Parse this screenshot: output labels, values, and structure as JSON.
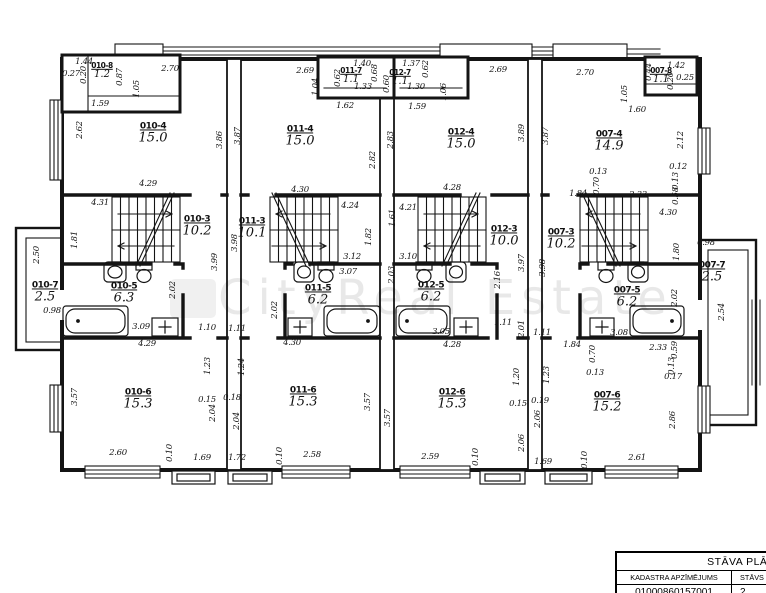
{
  "watermark": {
    "text": "CityReal Estate"
  },
  "title_block": {
    "title": "STĀVA PLĀNS",
    "col1_header": "KADASTRA APZĪMĒJUMS",
    "col2_header": "STĀVS",
    "col1_value": "01000860157001",
    "col2_value": "2"
  },
  "rooms": [
    {
      "id": "010-8",
      "area": "1.2",
      "x": 102,
      "y": 71,
      "s": 1
    },
    {
      "id": "011-7",
      "area": "1.1",
      "x": 351,
      "y": 76,
      "s": 1
    },
    {
      "id": "012-7",
      "area": "1.1",
      "x": 400,
      "y": 78,
      "s": 1
    },
    {
      "id": "007-8",
      "area": "1.1",
      "x": 661,
      "y": 76,
      "s": 1
    },
    {
      "id": "010-4",
      "area": "15.0",
      "x": 153,
      "y": 134
    },
    {
      "id": "011-4",
      "area": "15.0",
      "x": 300,
      "y": 137
    },
    {
      "id": "012-4",
      "area": "15.0",
      "x": 461,
      "y": 140
    },
    {
      "id": "007-4",
      "area": "14.9",
      "x": 609,
      "y": 142
    },
    {
      "id": "010-3",
      "area": "10.2",
      "x": 197,
      "y": 227
    },
    {
      "id": "011-3",
      "area": "10.1",
      "x": 252,
      "y": 229
    },
    {
      "id": "012-3",
      "area": "10.0",
      "x": 504,
      "y": 237
    },
    {
      "id": "007-3",
      "area": "10.2",
      "x": 561,
      "y": 240
    },
    {
      "id": "010-7",
      "area": "2.5",
      "x": 45,
      "y": 293
    },
    {
      "id": "007-7",
      "area": "2.5",
      "x": 712,
      "y": 273
    },
    {
      "id": "010-5",
      "area": "6.3",
      "x": 124,
      "y": 294
    },
    {
      "id": "011-5",
      "area": "6.2",
      "x": 318,
      "y": 296
    },
    {
      "id": "012-5",
      "area": "6.2",
      "x": 431,
      "y": 293
    },
    {
      "id": "007-5",
      "area": "6.2",
      "x": 627,
      "y": 298
    },
    {
      "id": "010-6",
      "area": "15.3",
      "x": 138,
      "y": 400
    },
    {
      "id": "011-6",
      "area": "15.3",
      "x": 303,
      "y": 398
    },
    {
      "id": "012-6",
      "area": "15.3",
      "x": 452,
      "y": 400
    },
    {
      "id": "007-6",
      "area": "15.2",
      "x": 607,
      "y": 403
    }
  ],
  "dims": [
    [
      "1.44",
      84,
      62,
      0
    ],
    [
      "0.27",
      71,
      74,
      0
    ],
    [
      "0.20",
      84,
      75,
      1
    ],
    [
      "0.87",
      120,
      77,
      1
    ],
    [
      "2.70",
      170,
      69,
      0
    ],
    [
      "1.05",
      137,
      89,
      1
    ],
    [
      "1.59",
      100,
      104,
      0
    ],
    [
      "2.62",
      80,
      130,
      1
    ],
    [
      "3.86",
      220,
      140,
      1
    ],
    [
      "4.29",
      148,
      184,
      0
    ],
    [
      "4.31",
      100,
      203,
      0
    ],
    [
      "1.81",
      75,
      240,
      1
    ],
    [
      "3.99",
      215,
      262,
      1
    ],
    [
      "2.02",
      173,
      290,
      1
    ],
    [
      "3.09",
      141,
      327,
      0
    ],
    [
      "1.10",
      207,
      328,
      0
    ],
    [
      "4.29",
      147,
      344,
      0
    ],
    [
      "2.50",
      37,
      255,
      1
    ],
    [
      "0.98",
      52,
      311,
      0
    ],
    [
      "1.23",
      208,
      366,
      1
    ],
    [
      "3.57",
      75,
      397,
      1
    ],
    [
      "0.15",
      207,
      400,
      0
    ],
    [
      "2.04",
      213,
      413,
      1
    ],
    [
      "2.60",
      118,
      453,
      0
    ],
    [
      "0.10",
      170,
      453,
      1
    ],
    [
      "1.69",
      202,
      458,
      0
    ],
    [
      "2.69",
      305,
      71,
      0
    ],
    [
      "1.40",
      362,
      64,
      0
    ],
    [
      "0.68",
      375,
      73,
      1
    ],
    [
      "0.62",
      338,
      78,
      1
    ],
    [
      "1.33",
      363,
      87,
      0
    ],
    [
      "1.04",
      316,
      87,
      1
    ],
    [
      "1.62",
      345,
      106,
      0
    ],
    [
      "1.37",
      411,
      64,
      0
    ],
    [
      "0.62",
      426,
      69,
      1
    ],
    [
      "0.60",
      387,
      84,
      1
    ],
    [
      "1.30",
      416,
      87,
      0
    ],
    [
      "1.06",
      444,
      92,
      1
    ],
    [
      "1.59",
      417,
      107,
      0
    ],
    [
      "2.69",
      498,
      70,
      0
    ],
    [
      "3.87",
      238,
      136,
      1
    ],
    [
      "2.82",
      373,
      160,
      1
    ],
    [
      "2.83",
      391,
      140,
      1
    ],
    [
      "3.89",
      522,
      133,
      1
    ],
    [
      "4.30",
      300,
      190,
      0
    ],
    [
      "4.28",
      452,
      188,
      0
    ],
    [
      "4.24",
      350,
      206,
      0
    ],
    [
      "1.82",
      369,
      237,
      1
    ],
    [
      "3.12",
      352,
      257,
      0
    ],
    [
      "3.98",
      235,
      243,
      1
    ],
    [
      "2.02",
      275,
      310,
      1
    ],
    [
      "3.07",
      348,
      272,
      0
    ],
    [
      "1.11",
      237,
      329,
      0
    ],
    [
      "4.30",
      292,
      343,
      0
    ],
    [
      "1.24",
      242,
      367,
      1
    ],
    [
      "0.18",
      232,
      398,
      0
    ],
    [
      "2.04",
      237,
      421,
      1
    ],
    [
      "1.72",
      237,
      458,
      0
    ],
    [
      "0.10",
      280,
      456,
      1
    ],
    [
      "2.58",
      312,
      455,
      0
    ],
    [
      "3.57",
      368,
      402,
      1
    ],
    [
      "4.21",
      408,
      208,
      0
    ],
    [
      "1.61",
      393,
      218,
      1
    ],
    [
      "3.10",
      408,
      257,
      0
    ],
    [
      "3.97",
      522,
      263,
      1
    ],
    [
      "2.16",
      498,
      280,
      1
    ],
    [
      "2.03",
      392,
      275,
      1
    ],
    [
      "3.05",
      441,
      332,
      0
    ],
    [
      "1.11",
      503,
      323,
      0
    ],
    [
      "2.01",
      522,
      329,
      1
    ],
    [
      "4.28",
      452,
      345,
      0
    ],
    [
      "3.57",
      388,
      418,
      1
    ],
    [
      "2.59",
      430,
      457,
      0
    ],
    [
      "0.10",
      476,
      457,
      1
    ],
    [
      "1.20",
      517,
      377,
      1
    ],
    [
      "0.15",
      518,
      404,
      0
    ],
    [
      "2.06",
      522,
      443,
      1
    ],
    [
      "2.70",
      585,
      73,
      0
    ],
    [
      "0.44",
      649,
      72,
      1
    ],
    [
      "1.42",
      676,
      66,
      0
    ],
    [
      "0.20",
      671,
      81,
      1
    ],
    [
      "0.25",
      685,
      78,
      0
    ],
    [
      "1.05",
      625,
      94,
      1
    ],
    [
      "1.60",
      637,
      110,
      0
    ],
    [
      "3.87",
      546,
      136,
      1
    ],
    [
      "2.12",
      681,
      140,
      1
    ],
    [
      "0.12",
      678,
      167,
      0
    ],
    [
      "0.13",
      676,
      181,
      1
    ],
    [
      "0.58",
      676,
      196,
      1
    ],
    [
      "0.13",
      598,
      172,
      0
    ],
    [
      "0.70",
      597,
      186,
      1
    ],
    [
      "1.84",
      578,
      194,
      0
    ],
    [
      "2.33",
      638,
      195,
      0
    ],
    [
      "4.30",
      668,
      213,
      0
    ],
    [
      "1.80",
      677,
      252,
      1
    ],
    [
      "3.98",
      543,
      268,
      1
    ],
    [
      "0.98",
      706,
      243,
      0
    ],
    [
      "2.02",
      675,
      298,
      1
    ],
    [
      "2.54",
      722,
      312,
      1
    ],
    [
      "3.08",
      619,
      333,
      0
    ],
    [
      "1.11",
      542,
      333,
      0
    ],
    [
      "1.84",
      572,
      345,
      0
    ],
    [
      "2.33",
      658,
      348,
      0
    ],
    [
      "1.23",
      547,
      375,
      1
    ],
    [
      "0.19",
      540,
      401,
      0
    ],
    [
      "2.06",
      538,
      419,
      1
    ],
    [
      "1.69",
      543,
      462,
      0
    ],
    [
      "0.70",
      593,
      354,
      1
    ],
    [
      "0.13",
      595,
      373,
      0
    ],
    [
      "0.59",
      675,
      350,
      1
    ],
    [
      "0.13",
      672,
      366,
      1
    ],
    [
      "0.17",
      673,
      377,
      0
    ],
    [
      "2.86",
      673,
      420,
      1
    ],
    [
      "2.61",
      637,
      458,
      0
    ],
    [
      "0.10",
      585,
      460,
      1
    ]
  ]
}
